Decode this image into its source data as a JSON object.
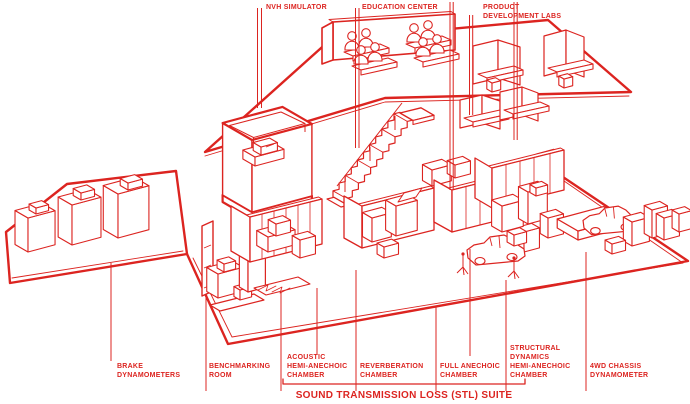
{
  "colors": {
    "red": "#dc2420",
    "background": "#ffffff"
  },
  "diagram": {
    "top_labels": {
      "nvh": {
        "lines": [
          "NVH SIMULATOR"
        ]
      },
      "education": {
        "lines": [
          "EDUCATION CENTER"
        ]
      },
      "pdl": {
        "lines": [
          "PRODUCT",
          "DEVELOPMENT LABS"
        ]
      }
    },
    "bottom_labels": {
      "brake": {
        "lines": [
          "BRAKE",
          "DYNAMOMETERS"
        ]
      },
      "benchmarking": {
        "lines": [
          "BENCHMARKING",
          "ROOM"
        ]
      },
      "acoustic": {
        "lines": [
          "ACOUSTIC",
          "HEMI-ANECHOIC",
          "CHAMBER"
        ]
      },
      "reverberation": {
        "lines": [
          "REVERBERATION",
          "CHAMBER"
        ]
      },
      "full_anechoic": {
        "lines": [
          "FULL ANECHOIC",
          "CHAMBER"
        ]
      },
      "structural": {
        "lines": [
          "STRUCTURAL",
          "DYNAMICS",
          "HEMI-ANECHOIC",
          "CHAMBER"
        ]
      },
      "chassis": {
        "lines": [
          "4WD CHASSIS",
          "DYNAMOMETER"
        ]
      }
    },
    "suite_title": "SOUND TRANSMISSION LOSS (STL) SUITE"
  }
}
